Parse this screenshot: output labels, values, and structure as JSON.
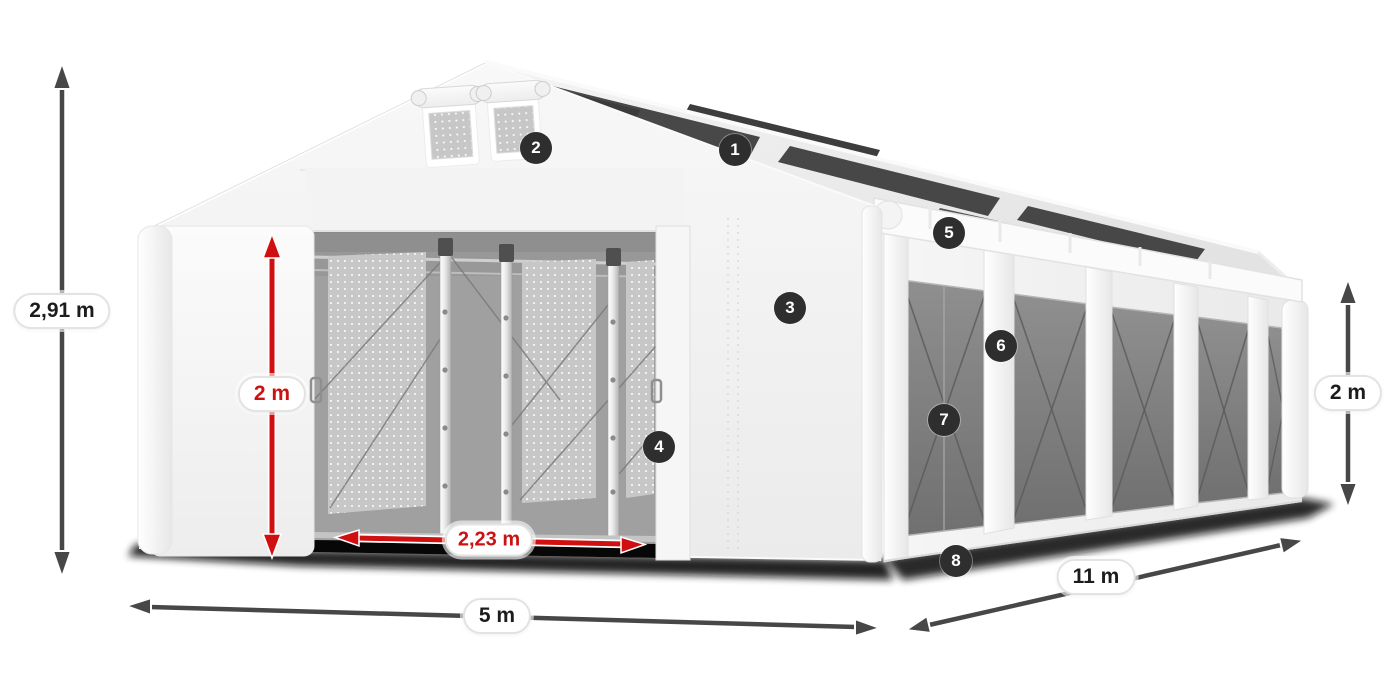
{
  "diagram": {
    "dimensions": {
      "total_height": {
        "label": "2,91 m",
        "style": "dark"
      },
      "entrance_height": {
        "label": "2 m",
        "style": "red"
      },
      "entrance_width": {
        "label": "2,23 m",
        "style": "red"
      },
      "front_width": {
        "label": "5 m",
        "style": "dark"
      },
      "side_length": {
        "label": "11 m",
        "style": "dark"
      },
      "side_height": {
        "label": "2 m",
        "style": "dark"
      }
    },
    "callouts": [
      {
        "number": "1"
      },
      {
        "number": "2"
      },
      {
        "number": "3"
      },
      {
        "number": "4"
      },
      {
        "number": "5"
      },
      {
        "number": "6"
      },
      {
        "number": "7"
      },
      {
        "number": "8"
      }
    ],
    "colors": {
      "accent_red": "#cc1111",
      "accent_red_arrow": "#d01010",
      "arrow_dark": "#474747",
      "badge_bg": "#2e2e2e",
      "badge_text": "#ffffff",
      "label_bg": "#ffffff",
      "label_border": "#e3e3e3",
      "label_text": "#1c1c1c"
    }
  }
}
